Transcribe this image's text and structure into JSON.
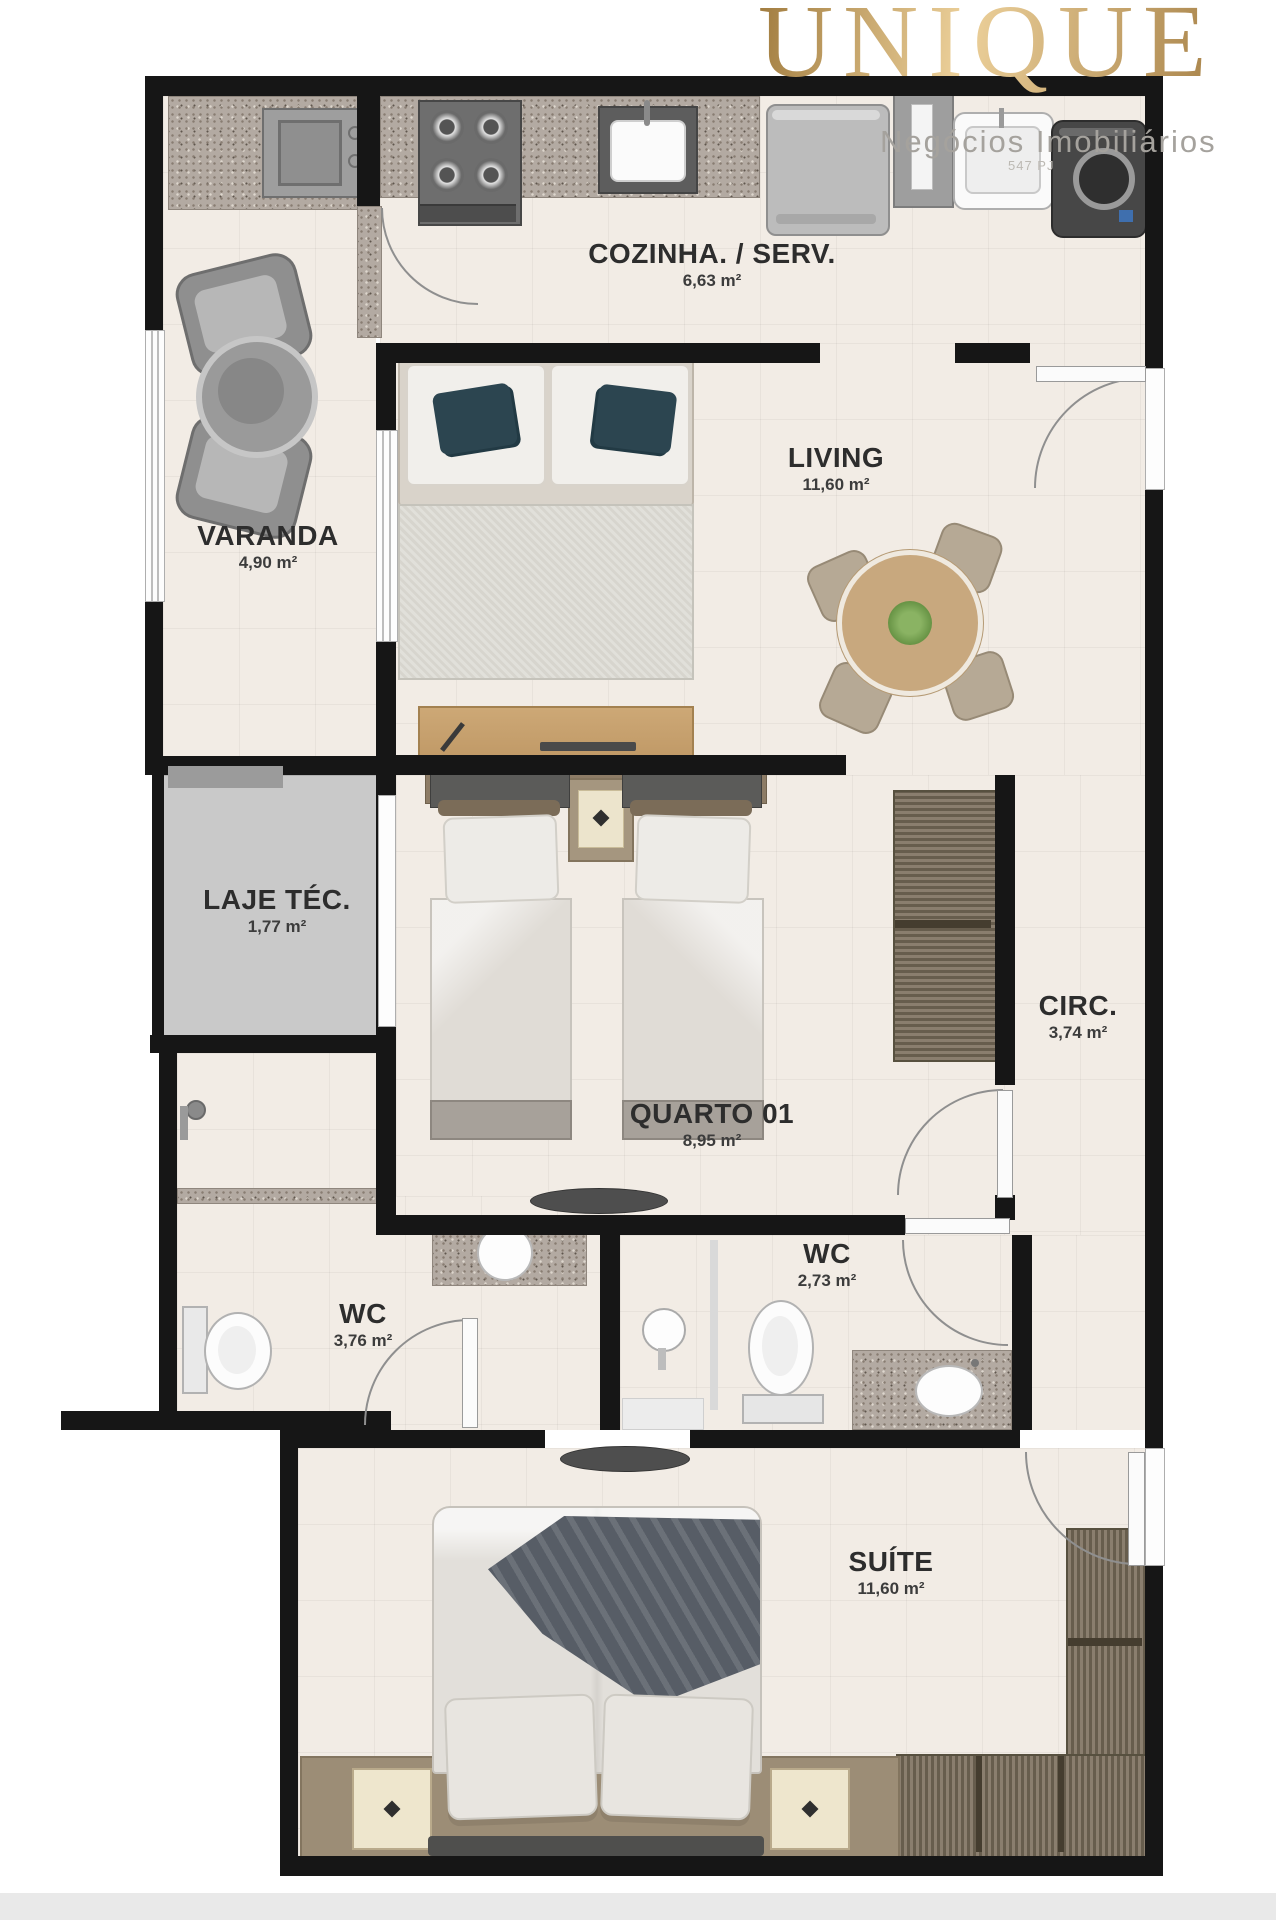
{
  "page": {
    "background": "#ffffff",
    "footer_bar_color": "#e9e9e9"
  },
  "logo": {
    "brand": "UNIQUE",
    "tagline": "Negócios Imobiliários",
    "registry": "547 PJ",
    "gold": "#c7a265",
    "tagline_color": "#a5a29d"
  },
  "plan": {
    "wall_color": "#161616",
    "floor_color": "#f2ece5",
    "granite_color": "#b3aaa2",
    "laje_fill": "#c9c9c9",
    "rooms": [
      {
        "id": "cozinha",
        "name": "COZINHA. / SERV.",
        "area": "6,63 m²"
      },
      {
        "id": "living",
        "name": "LIVING",
        "area": "11,60 m²"
      },
      {
        "id": "varanda",
        "name": "VARANDA",
        "area": "4,90 m²"
      },
      {
        "id": "laje-tec",
        "name": "LAJE TÉC.",
        "area": "1,77 m²"
      },
      {
        "id": "quarto-01",
        "name": "QUARTO 01",
        "area": "8,95 m²"
      },
      {
        "id": "circ",
        "name": "CIRC.",
        "area": "3,74 m²"
      },
      {
        "id": "wc-social",
        "name": "WC",
        "area": "3,76 m²"
      },
      {
        "id": "wc-suite",
        "name": "WC",
        "area": "2,73 m²"
      },
      {
        "id": "suite",
        "name": "SUÍTE",
        "area": "11,60 m²"
      }
    ]
  }
}
